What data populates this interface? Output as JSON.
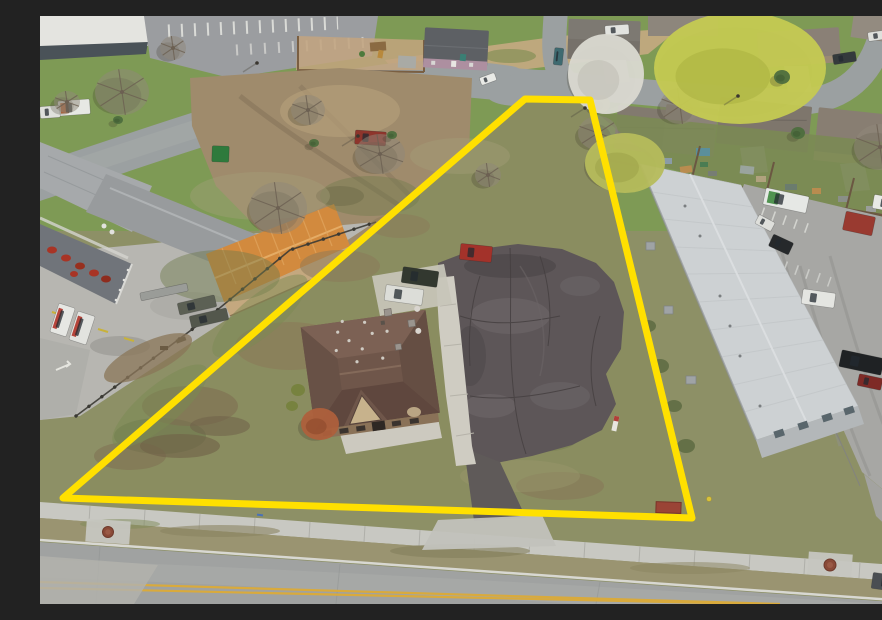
{
  "scene": {
    "kind": "aerial-drone-photograph",
    "subject": "vacant commercial parcel with office building highlighted by yellow property boundary",
    "boundary": {
      "points": "485,83 550,84 652,502 23,482",
      "color": "#FFE000",
      "width": 7
    },
    "colors": {
      "parcel_grass": "#8A8D60",
      "lawn": "#7E9A55",
      "road": "#9BA0A1",
      "road_fill": "#A0A2A1",
      "sidewalk": "#C8C8C2",
      "parking_lot": "#A7A7A4",
      "asphalt_pad": "#5D5658",
      "roadside_grass": "#9A9471",
      "curb": "#D8D8D2",
      "center_line": "#D9AA3C",
      "dirt_yard": "#9F8B6C",
      "concrete_yard": "#B7B6B1"
    },
    "buildings": {
      "office": {
        "label": "brown hip-roof office building on parcel",
        "roof": "#6F564A",
        "gable": "#C7B28C",
        "wall": "#8A7258"
      },
      "orange_shop": {
        "label": "orange metal shop building",
        "roof": "#D28A3E",
        "wall": "#C4A87F"
      },
      "warehouse": {
        "label": "large white warehouse",
        "roof": "#CDD1D3",
        "wall": "#B3B7B9"
      },
      "porch_house": {
        "label": "small gray-roof house with porch",
        "roof": "#666A64"
      },
      "purple_house": {
        "label": "two-story mauve house",
        "roof": "#5D6064",
        "wall": "#AD8FA0"
      }
    },
    "vehicles": [
      {
        "id": "red-suv-parcel",
        "x": 420,
        "y": 229,
        "w": 32,
        "h": 16,
        "r": 6,
        "c": "#A3322A"
      },
      {
        "id": "green-suv-parcel",
        "x": 362,
        "y": 253,
        "w": 36,
        "h": 16,
        "r": 8,
        "c": "#32382F"
      },
      {
        "id": "white-pickup-parcel",
        "x": 345,
        "y": 271,
        "w": 38,
        "h": 16,
        "r": 8,
        "c": "#DCDDD8"
      },
      {
        "id": "red-pickup-house",
        "x": 315,
        "y": 115,
        "w": 31,
        "h": 14,
        "r": 4,
        "c": "#8E352C"
      },
      {
        "id": "white-car-road",
        "x": 440,
        "y": 59,
        "w": 16,
        "h": 8,
        "r": -20,
        "c": "#E9EAE6"
      },
      {
        "id": "teal-car-street",
        "x": 514,
        "y": 32,
        "w": 9,
        "h": 17,
        "r": 6,
        "c": "#3E6A70"
      },
      {
        "id": "dark-car-street",
        "x": 793,
        "y": 37,
        "w": 23,
        "h": 10,
        "r": -9,
        "c": "#343A3C"
      },
      {
        "id": "red-car-street",
        "x": 849,
        "y": 90,
        "w": 22,
        "h": 10,
        "r": -8,
        "c": "#8E3036"
      },
      {
        "id": "white-car-top1",
        "x": 828,
        "y": 15,
        "w": 22,
        "h": 9,
        "r": -8,
        "c": "#DFE0DC"
      },
      {
        "id": "white-car-top2",
        "x": 858,
        "y": 7,
        "w": 19,
        "h": 8,
        "r": -8,
        "c": "#D8D9D5"
      },
      {
        "id": "white-van-top",
        "x": 565,
        "y": 9,
        "w": 24,
        "h": 10,
        "r": -4,
        "c": "#E2E3DF"
      },
      {
        "id": "garbage-truck",
        "x": 724,
        "y": 176,
        "w": 44,
        "h": 17,
        "r": 12,
        "c": "#E6E8E5",
        "a": "#3F8A3F"
      },
      {
        "id": "red-dumpster",
        "x": 804,
        "y": 198,
        "w": 30,
        "h": 19,
        "r": 12,
        "c": "#993A30",
        "g": false
      },
      {
        "id": "white-van-lot",
        "x": 833,
        "y": 181,
        "w": 32,
        "h": 14,
        "r": 10,
        "c": "#E8E9E5"
      },
      {
        "id": "white-sedan-lot",
        "x": 716,
        "y": 202,
        "w": 18,
        "h": 10,
        "r": 28,
        "c": "#DEDFDB"
      },
      {
        "id": "black-car-lot",
        "x": 730,
        "y": 222,
        "w": 22,
        "h": 13,
        "r": 25,
        "c": "#26292B"
      },
      {
        "id": "white-suv-lot",
        "x": 762,
        "y": 275,
        "w": 33,
        "h": 15,
        "r": 8,
        "c": "#E4E5E1"
      },
      {
        "id": "black-pickup-lot",
        "x": 800,
        "y": 338,
        "w": 43,
        "h": 17,
        "r": 12,
        "c": "#1F2224"
      },
      {
        "id": "red-car-lot",
        "x": 818,
        "y": 360,
        "w": 24,
        "h": 12,
        "r": 12,
        "c": "#7E2A26"
      },
      {
        "id": "gray-sedan-road",
        "x": 832,
        "y": 559,
        "w": 39,
        "h": 16,
        "r": 8,
        "c": "#4A4E52"
      },
      {
        "id": "box-truck-1",
        "x": 14,
        "y": 289,
        "w": 17,
        "h": 30,
        "r": 18,
        "c": "#E6E7E3",
        "a": "#B03228"
      },
      {
        "id": "box-truck-2",
        "x": 33,
        "y": 297,
        "w": 18,
        "h": 30,
        "r": 18,
        "c": "#E2E3DF",
        "a": "#B03228"
      },
      {
        "id": "military-truck-1",
        "x": 138,
        "y": 283,
        "w": 38,
        "h": 12,
        "r": -13,
        "c": "#5C6054"
      },
      {
        "id": "military-truck-2",
        "x": 150,
        "y": 296,
        "w": 38,
        "h": 12,
        "r": -13,
        "c": "#53574C"
      },
      {
        "id": "flatbed-trailer",
        "x": 100,
        "y": 272,
        "w": 48,
        "h": 8,
        "r": -12,
        "c": "#9A9C98",
        "g": false
      },
      {
        "id": "uhaul-truck-1",
        "x": 18,
        "y": 84,
        "w": 32,
        "h": 15,
        "r": -4,
        "c": "#E7E8E4",
        "a": "#C8622F"
      },
      {
        "id": "uhaul-truck-2",
        "x": 0,
        "y": 90,
        "w": 20,
        "h": 12,
        "r": -4,
        "c": "#DFE0DC"
      },
      {
        "id": "green-dumpster",
        "x": 172,
        "y": 130,
        "w": 17,
        "h": 16,
        "r": 2,
        "c": "#2E7A3C",
        "g": false
      }
    ],
    "trees": [
      {
        "type": "bare",
        "x": 82,
        "y": 76,
        "rx": 27,
        "ry": 23
      },
      {
        "type": "bare",
        "x": 27,
        "y": 86,
        "rx": 13,
        "ry": 11
      },
      {
        "type": "bare",
        "x": 238,
        "y": 192,
        "rx": 29,
        "ry": 26
      },
      {
        "type": "bare",
        "x": 448,
        "y": 159,
        "rx": 13,
        "ry": 12
      },
      {
        "type": "bare",
        "x": 640,
        "y": 90,
        "rx": 20,
        "ry": 18
      },
      {
        "type": "bare",
        "x": 558,
        "y": 117,
        "rx": 20,
        "ry": 17
      },
      {
        "type": "bare",
        "x": 840,
        "y": 131,
        "rx": 26,
        "ry": 23
      },
      {
        "type": "bare",
        "x": 268,
        "y": 94,
        "rx": 17,
        "ry": 15
      },
      {
        "type": "bare",
        "x": 340,
        "y": 138,
        "rx": 25,
        "ry": 20
      },
      {
        "type": "bare",
        "x": 133,
        "y": 32,
        "rx": 13,
        "ry": 12
      },
      {
        "type": "willow",
        "x": 585,
        "y": 147,
        "rx": 40,
        "ry": 30
      },
      {
        "type": "willow",
        "x": 560,
        "y": 88,
        "rx": 10,
        "ry": 9
      },
      {
        "type": "yellow",
        "x": 700,
        "y": 52,
        "rx": 86,
        "ry": 56
      },
      {
        "type": "white",
        "x": 566,
        "y": 58,
        "rx": 38,
        "ry": 40
      },
      {
        "type": "green",
        "x": 742,
        "y": 61,
        "rx": 8,
        "ry": 7
      },
      {
        "type": "green",
        "x": 758,
        "y": 117,
        "rx": 7,
        "ry": 6
      },
      {
        "type": "green",
        "x": 874,
        "y": 69,
        "rx": 9,
        "ry": 8
      },
      {
        "type": "green",
        "x": 352,
        "y": 119,
        "rx": 5,
        "ry": 4
      },
      {
        "type": "green",
        "x": 274,
        "y": 127,
        "rx": 5,
        "ry": 4
      },
      {
        "type": "green",
        "x": 78,
        "y": 104,
        "rx": 5,
        "ry": 4
      },
      {
        "type": "orange",
        "x": 280,
        "y": 408,
        "rx": 19,
        "ry": 16
      }
    ],
    "tree_palette": {
      "bare": "#90887A",
      "bare_branch": "#6C6052",
      "yellow": "#C5CA52",
      "yellow_dark": "#A9B13F",
      "white": "#DAD9D1",
      "white_dark": "#BFBEB5",
      "willow": "#B6BC5C",
      "willow_dark": "#9CA348",
      "green": "#4E6E3E",
      "green_dark": "#3E5A32",
      "orange": "#AE603C",
      "orange_dark": "#8B4729",
      "shadow": "rgba(60,55,40,0.25)"
    },
    "manholes": {
      "cover": "#8A4A38",
      "rim": "#6E3A2C",
      "pad": "#C6C6C0",
      "items": [
        {
          "x": 68,
          "y": 516,
          "r": 5.5
        },
        {
          "x": 790,
          "y": 549,
          "r": 6
        }
      ]
    }
  }
}
